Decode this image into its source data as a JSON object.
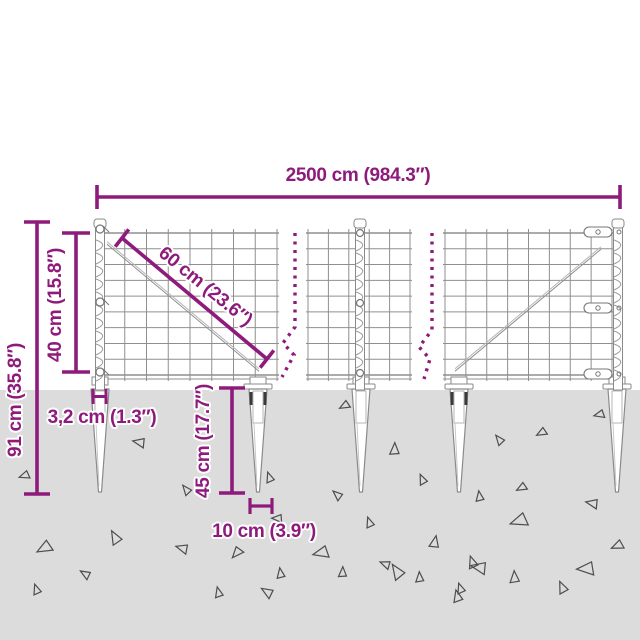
{
  "diagram": {
    "title": "fence-with-ground-spikes-dimension-diagram"
  },
  "dimensions": {
    "total_width": {
      "label": "2500 cm (984.3″)"
    },
    "total_height": {
      "label": "91 cm (35.8″)"
    },
    "mesh_height": {
      "label": "40 cm (15.8″)"
    },
    "mesh_diagonal": {
      "label": "60 cm (23.6″)"
    },
    "spike_top_width": {
      "label": "3,2 cm (1.3″)"
    },
    "spike_depth": {
      "label": "45 cm (17.7″)"
    },
    "spike_anchor_width": {
      "label": "10 cm (3.9″)"
    }
  },
  "colors": {
    "dimension_accent": "#8E1B7C",
    "background": "#FFFFFF",
    "ground": "#DCDCDC",
    "wire": "#8F8F8F",
    "wire_light": "#B5B5B5",
    "metal_fill": "#FFFFFF",
    "bolt_dark": "#3A3A3A",
    "gravel_stroke": "#4D4D4D"
  },
  "ground": {
    "triangles": [
      [
        140,
        442,
        7,
        40
      ],
      [
        25,
        475,
        6,
        10
      ],
      [
        45,
        547,
        9,
        0
      ],
      [
        116,
        538,
        8,
        90
      ],
      [
        183,
        548,
        7,
        45
      ],
      [
        187,
        490,
        6,
        80
      ],
      [
        237,
        552,
        7,
        -20
      ],
      [
        268,
        592,
        7,
        60
      ],
      [
        278,
        518,
        6,
        30
      ],
      [
        270,
        478,
        6,
        100
      ],
      [
        345,
        405,
        6,
        0
      ],
      [
        395,
        450,
        7,
        120
      ],
      [
        500,
        440,
        6,
        80
      ],
      [
        542,
        432,
        6,
        0
      ],
      [
        600,
        414,
        6,
        15
      ],
      [
        423,
        480,
        6,
        95
      ],
      [
        480,
        497,
        6,
        110
      ],
      [
        522,
        487,
        6,
        0
      ],
      [
        338,
        495,
        6,
        70
      ],
      [
        370,
        523,
        6,
        100
      ],
      [
        593,
        503,
        7,
        40
      ],
      [
        520,
        520,
        10,
        10
      ],
      [
        435,
        543,
        7,
        130
      ],
      [
        322,
        552,
        9,
        15
      ],
      [
        343,
        573,
        6,
        120
      ],
      [
        398,
        572,
        9,
        85
      ],
      [
        473,
        563,
        7,
        100
      ],
      [
        587,
        568,
        10,
        25
      ],
      [
        515,
        578,
        7,
        115
      ],
      [
        563,
        588,
        7,
        95
      ],
      [
        618,
        545,
        7,
        5
      ],
      [
        458,
        597,
        7,
        105
      ],
      [
        37,
        590,
        6,
        100
      ],
      [
        86,
        574,
        6,
        60
      ],
      [
        219,
        593,
        6,
        105
      ],
      [
        281,
        574,
        6,
        110
      ],
      [
        386,
        564,
        6,
        50
      ],
      [
        420,
        578,
        6,
        115
      ],
      [
        461,
        589,
        6,
        100
      ],
      [
        480,
        567,
        9,
        40
      ]
    ]
  }
}
